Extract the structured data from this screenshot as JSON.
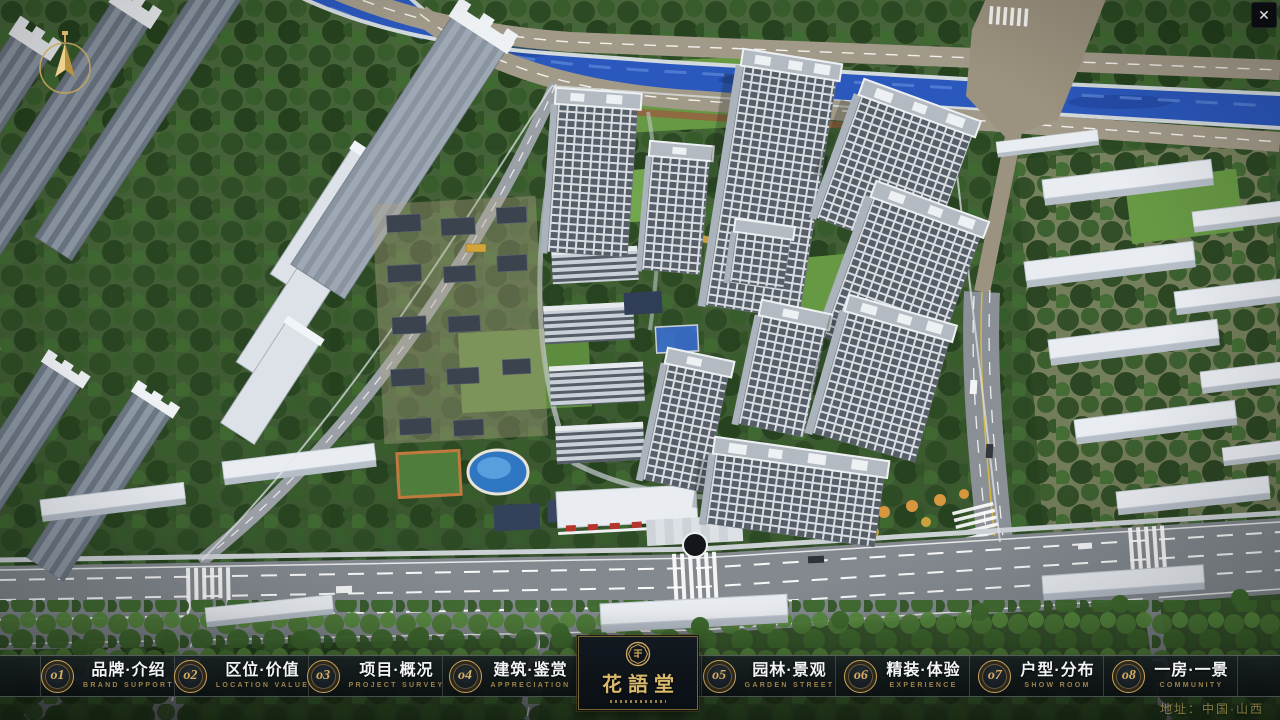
{
  "app": {
    "close_glyph": "✕"
  },
  "navbar": {
    "items": [
      {
        "num": "o1",
        "zh": "品牌·介绍",
        "en": "BRAND SUPPORT"
      },
      {
        "num": "o2",
        "zh": "区位·价值",
        "en": "LOCATION VALUE"
      },
      {
        "num": "o3",
        "zh": "项目·概况",
        "en": "PROJECT SURVEY"
      },
      {
        "num": "o4",
        "zh": "建筑·鉴赏",
        "en": "APPRECIATION"
      },
      {
        "num": "o5",
        "zh": "园林·景观",
        "en": "GARDEN STREET"
      },
      {
        "num": "o6",
        "zh": "精装·体验",
        "en": "EXPERIENCE"
      },
      {
        "num": "o7",
        "zh": "户型·分布",
        "en": "SHOW ROOM"
      },
      {
        "num": "o8",
        "zh": "一房·一景",
        "en": "COMMUNITY"
      }
    ],
    "logo": {
      "title": "花語堂"
    }
  },
  "footer": {
    "address": "地址：中国·山西"
  },
  "scene": {
    "colors": {
      "accent_gold": "#c9a45c",
      "logo_gold": "#d9b96c",
      "navbar_bg": "#10161b",
      "river_blue": "#2b58bd",
      "canopy_green": "#2f4e26",
      "grass_green": "#679944",
      "road_gray": "#83898f",
      "tower_white": "#e4e8ec",
      "slab_gray": "#8d98a5"
    }
  }
}
